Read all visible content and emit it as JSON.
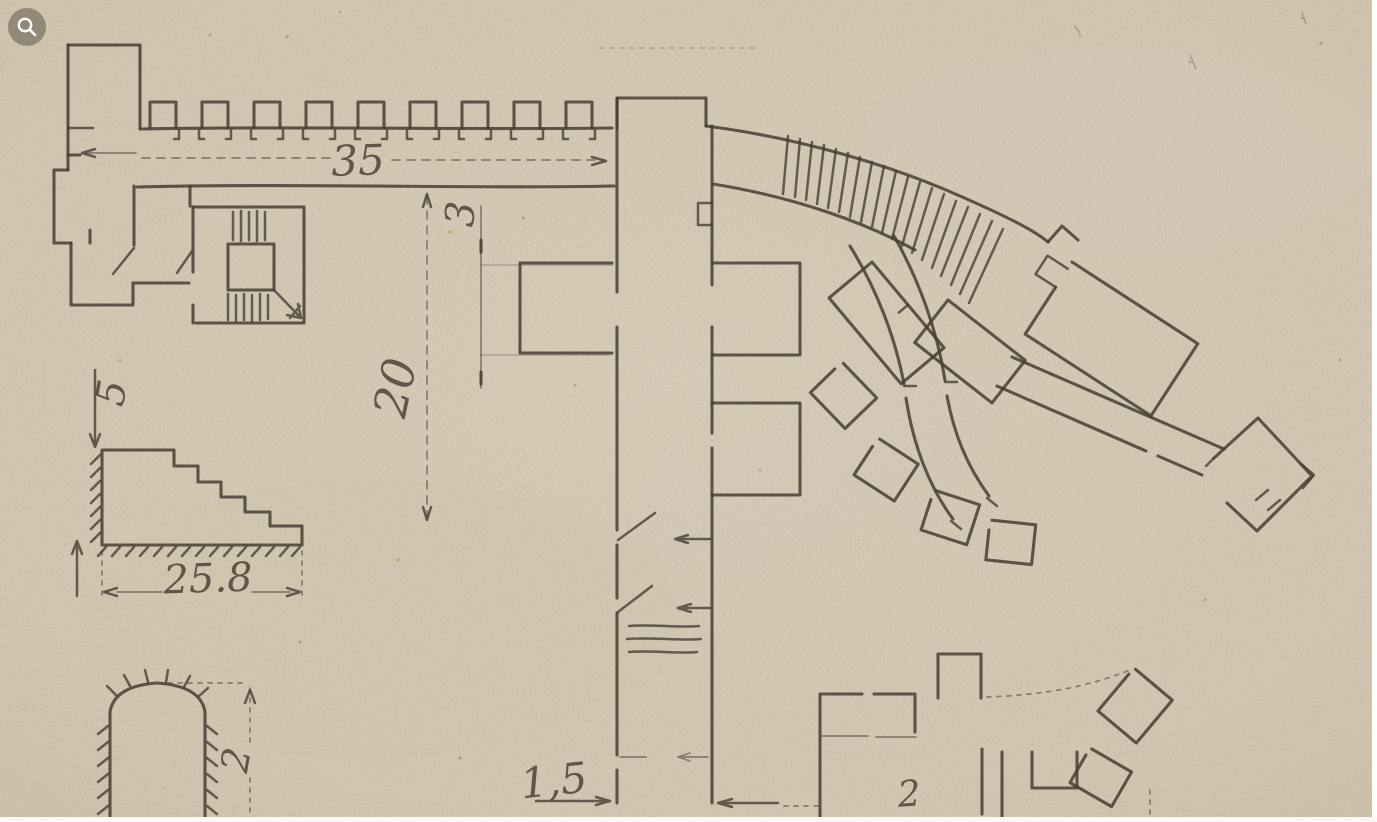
{
  "viewer": {
    "zoom_button_icon": "magnifier-icon"
  },
  "palette": {
    "paper": "#d9cdb8",
    "ink": "#463e33",
    "zoom_button_bg": "rgba(112,102,88,0.62)",
    "edge_strip": "#ffffff"
  },
  "plan_labels": {
    "battlement_length": "35",
    "court_depth": "20",
    "gallery_gap": "3",
    "stair_height": "5",
    "stair_length": "25.8",
    "tunnel_height": "2",
    "corridor_width": "1,5",
    "block_label": "2"
  }
}
